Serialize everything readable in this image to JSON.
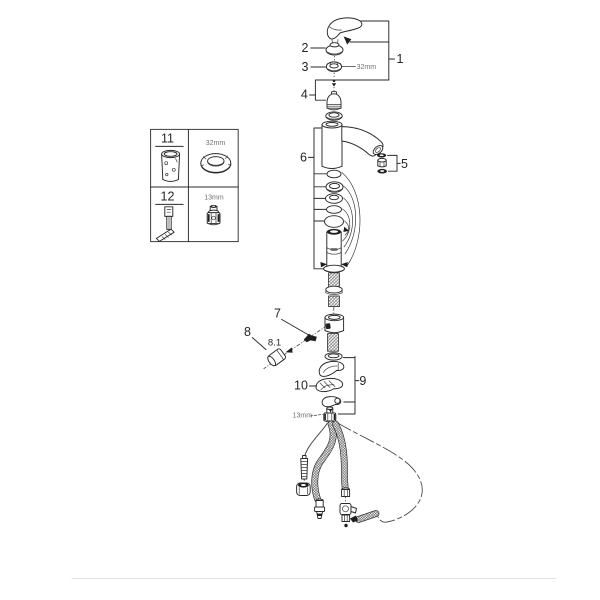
{
  "diagram": {
    "description": "faucet exploded parts diagram",
    "colors": {
      "line": "#2a2a2a",
      "muted_label": "#707070",
      "background": "#ffffff"
    },
    "callouts": {
      "c1": "1",
      "c2": "2",
      "c3": "3",
      "c4": "4",
      "c5": "5",
      "c6": "6",
      "c7": "7",
      "c8": "8",
      "c8_1": "8.1",
      "c9": "9",
      "c10": "10"
    },
    "annotations": {
      "cartridge_nut_size": "32mm",
      "hose_nut_size": "13mm"
    },
    "inset": {
      "rows": [
        {
          "tool_number": "11",
          "tool_size": "32mm"
        },
        {
          "tool_number": "12",
          "tool_size": "13mm"
        }
      ]
    }
  }
}
